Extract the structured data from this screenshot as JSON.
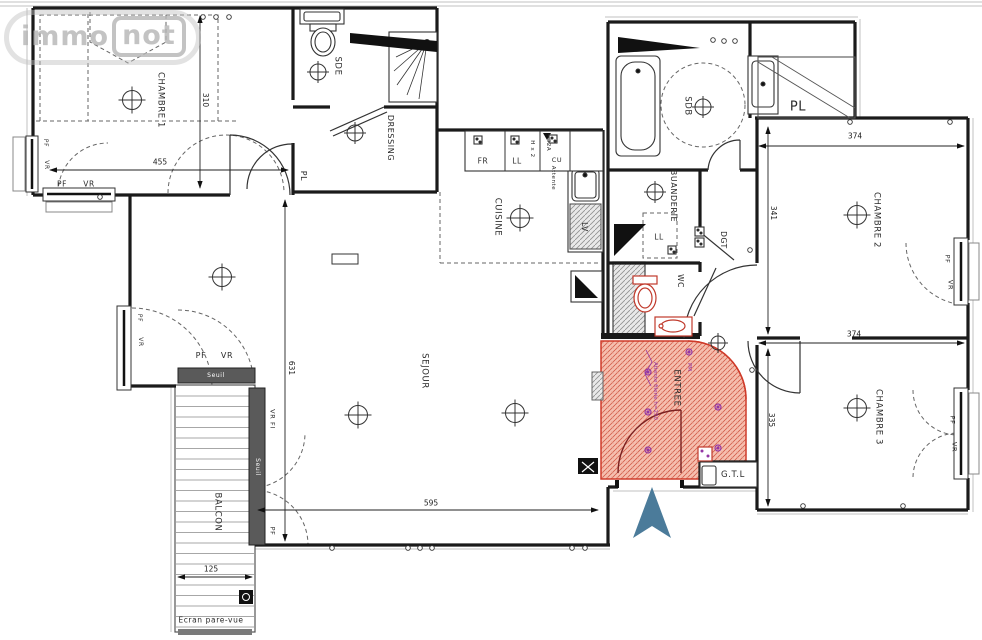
{
  "watermark": {
    "part1": "immo",
    "part2": "not"
  },
  "labels": {
    "pf": "PF",
    "vr": "VR",
    "seuil": "Seuil",
    "vr_fi": "VR FI",
    "chambre1": "CHAMBRE 1",
    "chambre2": "CHAMBRE 2",
    "chambre3": "CHAMBRE 3",
    "sde": "SDE",
    "dressing": "DRESSING",
    "pl": "PL",
    "cuisine": "CUISINE",
    "sejour": "SEJOUR",
    "balcon": "BALCON",
    "sdb": "SDB",
    "buanderie": "BUANDERIE",
    "wc": "WC",
    "dgt": "DGT",
    "entree": "ENTREE",
    "gtl": "G.T.L",
    "ecran_pare_vue": "Ecran pare-vue",
    "lv": "LV",
    "fr": "FR",
    "ll": "LL",
    "hx2": "H x 2",
    "a32": "32A",
    "cu": "CU",
    "attente": "Attente",
    "attente_filerie": "Attente filerie h=250",
    "pm": "PM"
  },
  "dimensions_cm": {
    "chambre1_width": "455",
    "chambre1_depth": "310",
    "sejour_depth": "631",
    "sejour_width": "595",
    "balcon_width": "125",
    "chambre2_width": "374",
    "chambre2_depth": "341",
    "chambre3_width": "374",
    "chambre3_depth": "335"
  },
  "colors": {
    "entree_zone_fill": "#f6c0b0",
    "entree_zone_line": "#cf3b2a",
    "north_arrow": "#4b7b9a",
    "electrical_purple": "#9337a5",
    "wall": "#1a1a1a"
  }
}
